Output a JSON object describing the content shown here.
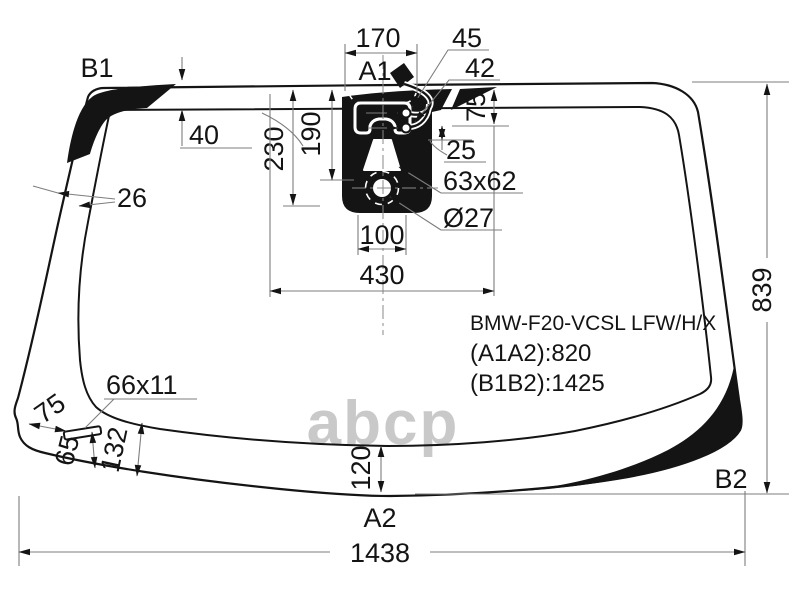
{
  "diagram": {
    "part_code": "BMW-F20-VCSL LFW/H/X",
    "spec_a1a2": "(A1A2):820",
    "spec_b1b2": "(B1B2):1425",
    "watermark": "abcp",
    "labels": {
      "b1": "B1",
      "b2": "B2",
      "a1": "A1",
      "a2": "A2",
      "d170": "170",
      "d45": "45",
      "d42": "42",
      "d40": "40",
      "d26": "26",
      "d230": "230",
      "d190": "190",
      "d75top": "75",
      "d25": "25",
      "d63x62": "63x62",
      "dO27": "Ø27",
      "d100": "100",
      "d430": "430",
      "d839": "839",
      "d66x11": "66x11",
      "d75bot": "75",
      "d65": "65",
      "d132": "132",
      "d120": "120",
      "d1438": "1438"
    },
    "colors": {
      "line": "#141414",
      "dimension": "#7d7d7d",
      "watermark": "#c9c9c9",
      "background": "#ffffff"
    }
  }
}
